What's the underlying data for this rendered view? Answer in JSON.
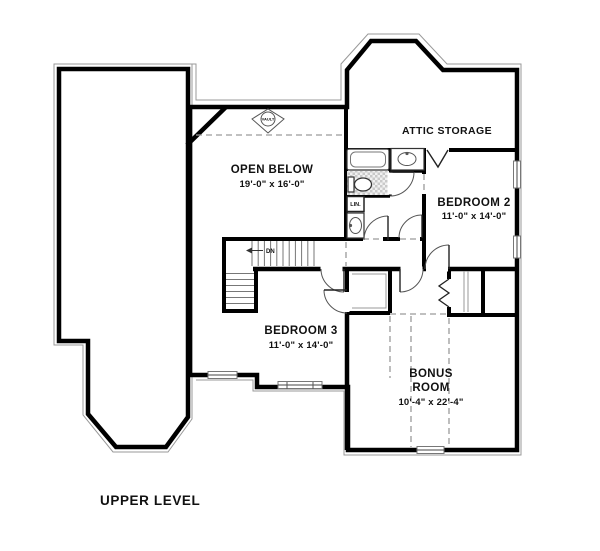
{
  "plan": {
    "level_title": "UPPER LEVEL",
    "rooms": {
      "open_below": {
        "name": "OPEN BELOW",
        "dims": "19'-0\" x 16'-0\""
      },
      "attic_storage": {
        "name": "ATTIC STORAGE"
      },
      "bedroom2": {
        "name": "BEDROOM 2",
        "dims": "11'-0\" x 14'-0\""
      },
      "bedroom3": {
        "name": "BEDROOM 3",
        "dims": "11'-0\" x 14'-0\""
      },
      "bonus_room": {
        "name_line1": "BONUS",
        "name_line2": "ROOM",
        "dims": "10'-4\" x 22'-4\""
      }
    },
    "labels": {
      "linen_closet": "LIN.",
      "stairs_direction": "DN",
      "ceiling_symbol": "VAULT"
    },
    "colors": {
      "wall": "#000000",
      "thin_outline": "#999999",
      "dashed_line": "#9a9a9a",
      "background": "#ffffff",
      "text": "#111111"
    }
  }
}
